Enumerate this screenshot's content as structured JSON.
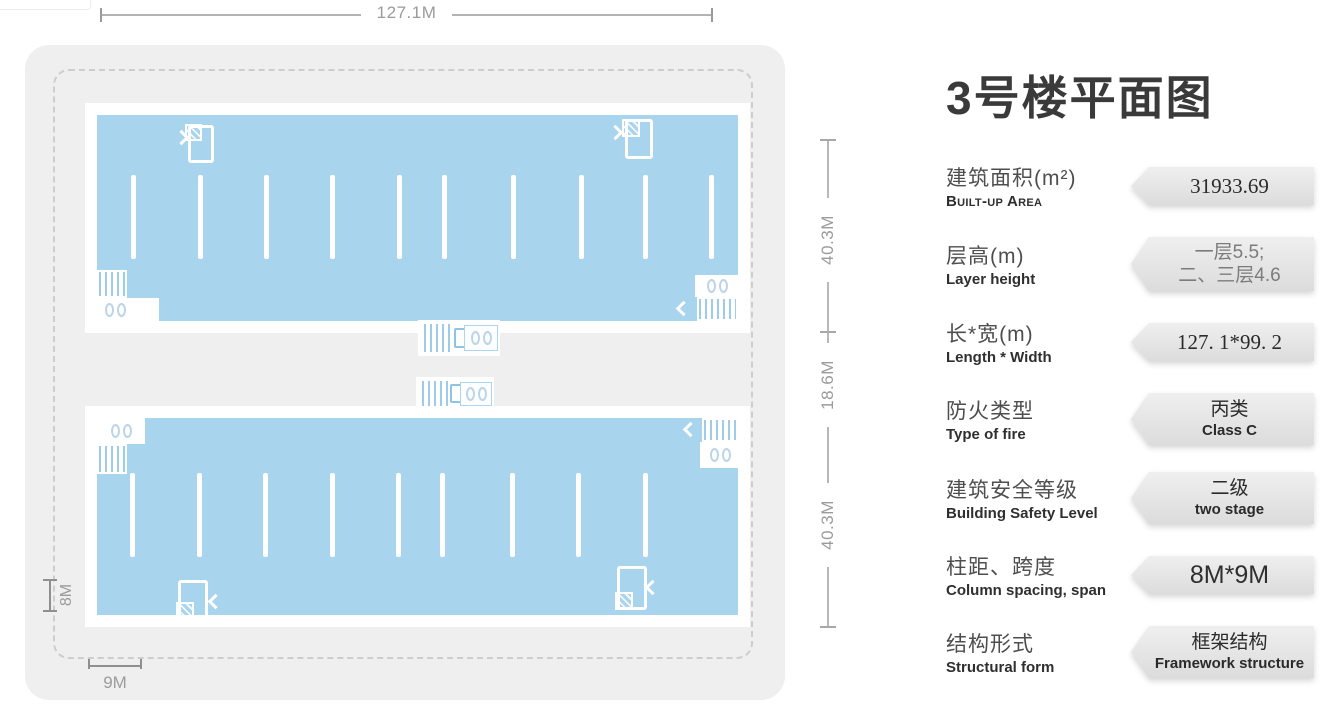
{
  "title": "3号楼平面图",
  "colors": {
    "building_fill": "#a9d4ee",
    "panel_bg": "#f0efef",
    "banner_bg": "#e3e3e3",
    "dim_text": "#9b9b9b",
    "title_text": "#3a3a3a"
  },
  "plan": {
    "dim_top": "127.1M",
    "dim_right_segments": [
      {
        "label": "40.3M"
      },
      {
        "label": "18.6M"
      },
      {
        "label": "40.3M"
      }
    ],
    "dim_left": "8M",
    "dim_bottom": "9M",
    "upper_column_x": [
      34,
      101,
      167,
      233,
      300,
      345,
      414,
      482,
      546,
      612
    ],
    "lower_column_x": [
      33,
      100,
      166,
      233,
      299,
      343,
      413,
      479,
      546
    ]
  },
  "specs": [
    {
      "id": "built-up-area",
      "zh": "建筑面积(m²)",
      "en": "Built-up Area",
      "en_smallcaps": true,
      "values": [
        "31933.69"
      ],
      "value_style": "serif"
    },
    {
      "id": "layer-height",
      "zh": "层高(m)",
      "en": "Layer height",
      "en_smallcaps": false,
      "values": [
        "一层5.5;",
        "二、三层4.6"
      ],
      "value_style": "muted"
    },
    {
      "id": "length-width",
      "zh": "长*宽(m)",
      "en": "Length * Width",
      "en_smallcaps": false,
      "values": [
        "127. 1*99. 2"
      ],
      "value_style": "serif"
    },
    {
      "id": "fire-type",
      "zh": "防火类型",
      "en": "Type of fire",
      "en_smallcaps": false,
      "values": [
        "丙类",
        "Class C"
      ],
      "value_style": "plain"
    },
    {
      "id": "safety-level",
      "zh": "建筑安全等级",
      "en": "Building Safety Level",
      "en_smallcaps": false,
      "values": [
        "二级",
        "two stage"
      ],
      "value_style": "plain"
    },
    {
      "id": "column-span",
      "zh": "柱距、跨度",
      "en": "Column spacing, span",
      "en_smallcaps": false,
      "values": [
        "8M*9M"
      ],
      "value_style": "large"
    },
    {
      "id": "structure-form",
      "zh": "结构形式",
      "en": "Structural form",
      "en_smallcaps": false,
      "values": [
        "框架结构",
        "Framework structure"
      ],
      "value_style": "plain"
    }
  ]
}
